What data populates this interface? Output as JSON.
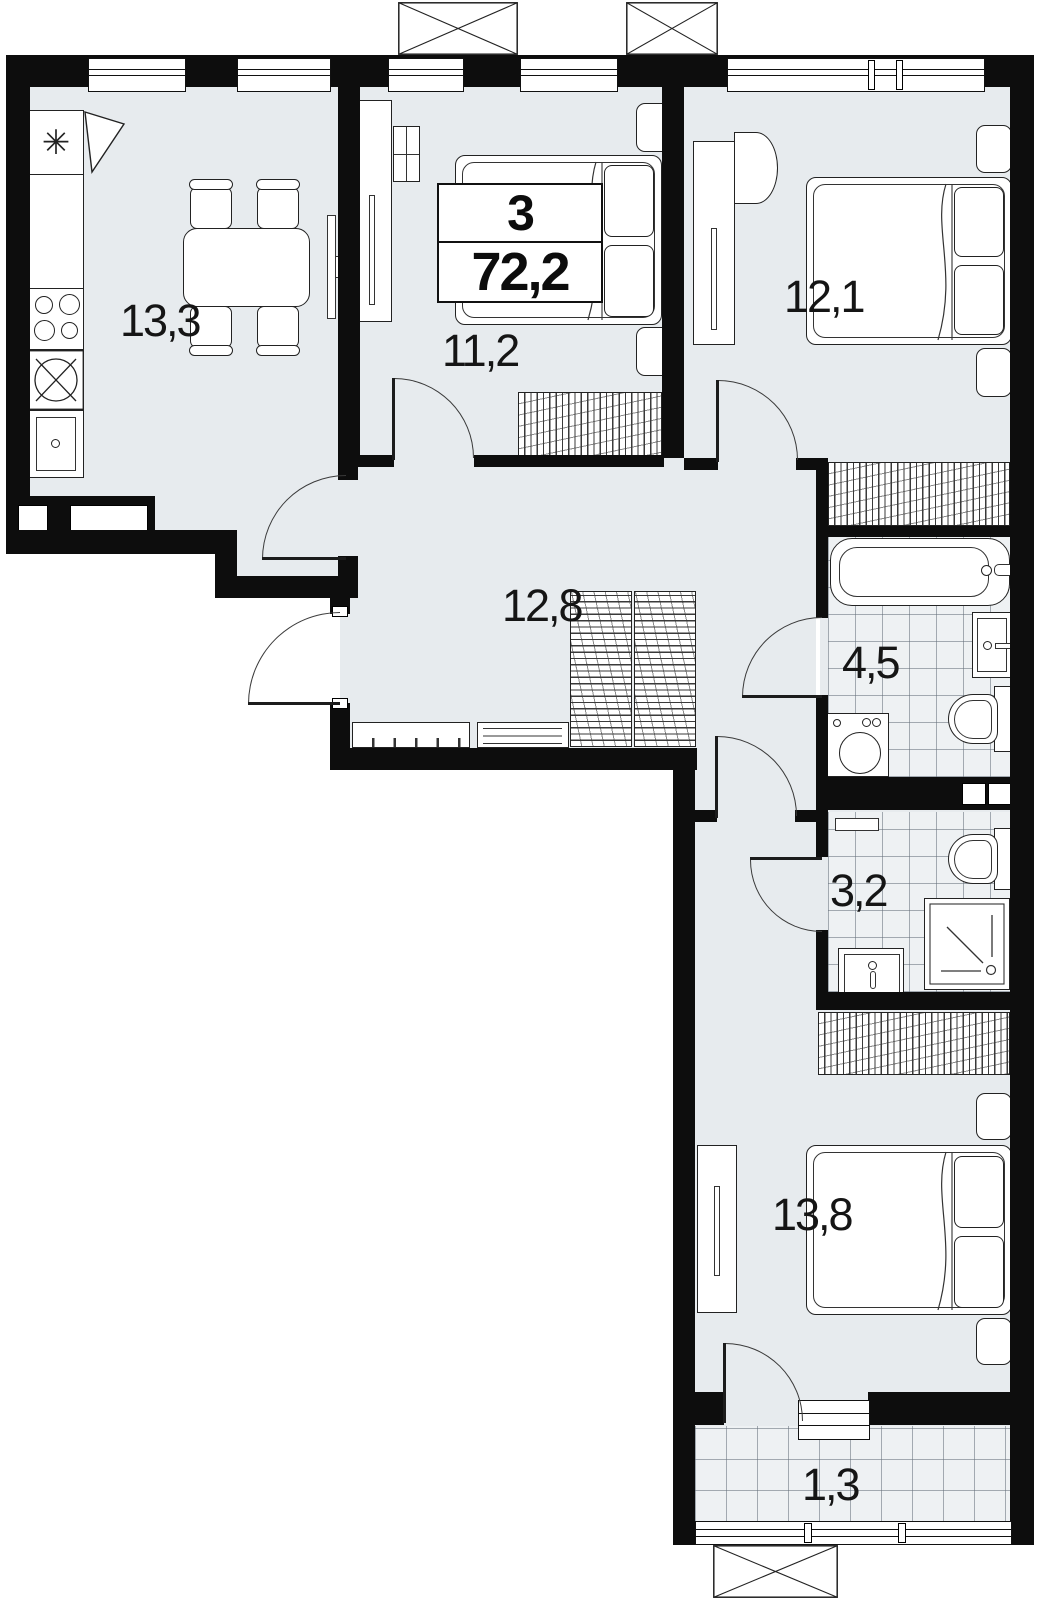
{
  "plan": {
    "summary": {
      "room_count": "3",
      "total_area": "72,2"
    },
    "rooms": {
      "kitchen": {
        "area": "13,3"
      },
      "bedroom_center": {
        "area": "11,2"
      },
      "bedroom_right": {
        "area": "12,1"
      },
      "hallway": {
        "area": "12,8"
      },
      "bathroom": {
        "area": "4,5"
      },
      "wc": {
        "area": "3,2"
      },
      "bedroom_bottom": {
        "area": "13,8"
      },
      "balcony": {
        "area": "1,3"
      }
    },
    "icons": {
      "fridge_snowflake": "✳"
    },
    "colors": {
      "wall": "#0d0d0d",
      "room_fill": "#e7ebee",
      "tile_fill": "#eef1f3",
      "background": "#ffffff"
    }
  }
}
